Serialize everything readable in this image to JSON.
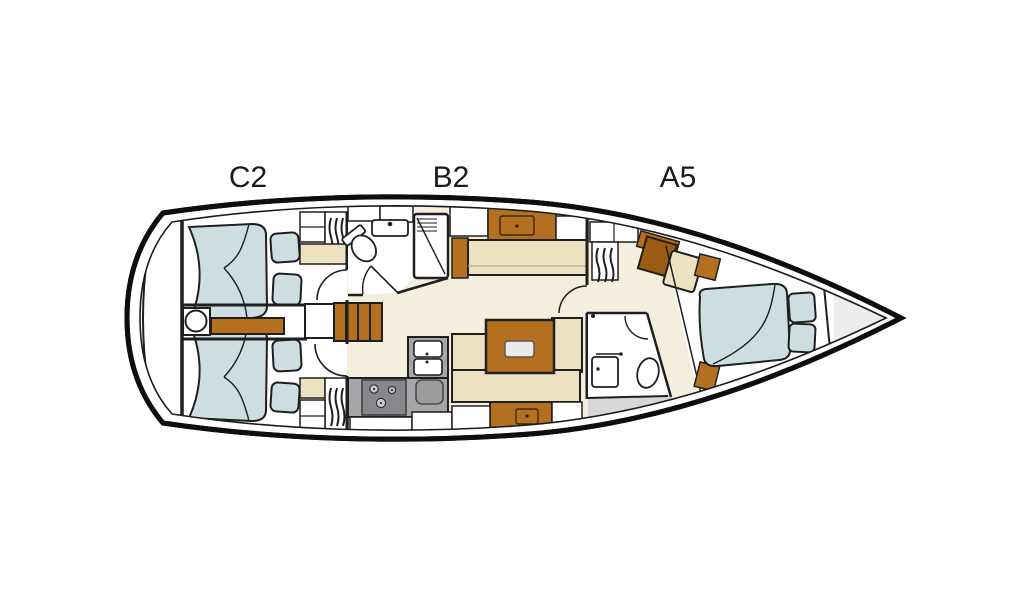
{
  "diagram": {
    "title_labels": {
      "aft_section": "C2",
      "saloon_section": "B2",
      "forward_section": "A5"
    }
  },
  "colors": {
    "line": "#1f1f1f",
    "hull": "#0e0e0e",
    "mattress": "#cddee1",
    "upholstery": "#ece1c1",
    "wood": "#b4701f",
    "wood_dark": "#9a5c12",
    "floor": "#f4eedd",
    "counter": "#a6a6a8",
    "stove": "#87888c",
    "metal": "#9c9c9e",
    "cell_gray": "#d7d7d9"
  }
}
